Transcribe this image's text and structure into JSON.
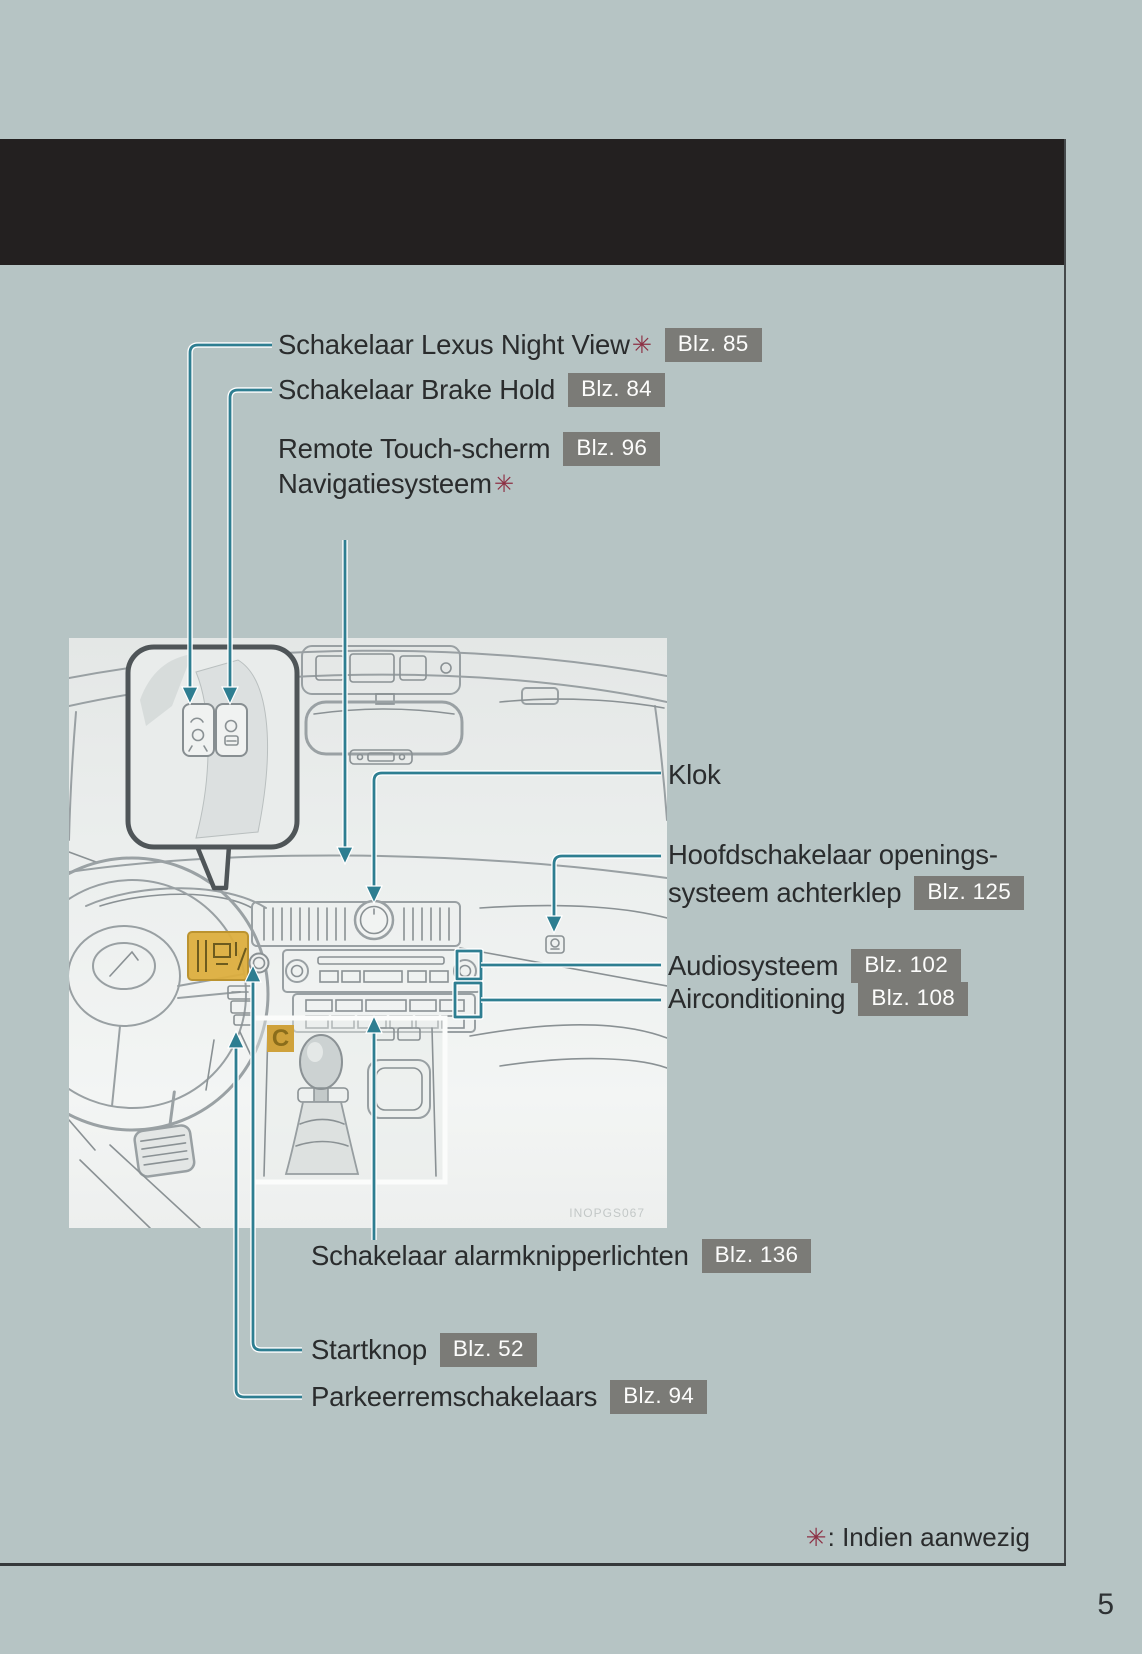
{
  "page": {
    "number": "5",
    "background_color": "#b6c4c4",
    "header_bar_color": "#232020",
    "accent_teal": "#2e7e91",
    "badge_gray": "#7b7b77",
    "asterisk_maroon": "#8d3044"
  },
  "footnote": {
    "asterisk": "✳",
    "text": ": Indien aanwezig"
  },
  "illustration": {
    "watermark": "INOPGS067",
    "inset_label": "C"
  },
  "callouts": [
    {
      "label": "Schakelaar Lexus Night View",
      "asterisk": "✳",
      "badge": "Blz. 85"
    },
    {
      "label": "Schakelaar Brake Hold",
      "badge": "Blz. 84"
    },
    {
      "label": "Remote Touch-scherm",
      "badge": "Blz. 96"
    },
    {
      "label": "Navigatiesysteem",
      "asterisk": "✳"
    },
    {
      "label": "Klok"
    },
    {
      "label": "Hoofdschakelaar openings-"
    },
    {
      "label": "systeem achterklep",
      "badge": "Blz. 125"
    },
    {
      "label": "Audiosysteem",
      "badge": "Blz. 102"
    },
    {
      "label": "Airconditioning",
      "badge": "Blz. 108"
    },
    {
      "label": "Schakelaar alarmknipperlichten",
      "badge": "Blz. 136"
    },
    {
      "label": "Startknop",
      "badge": "Blz. 52"
    },
    {
      "label": "Parkeerremschakelaars",
      "badge": "Blz. 94"
    }
  ]
}
